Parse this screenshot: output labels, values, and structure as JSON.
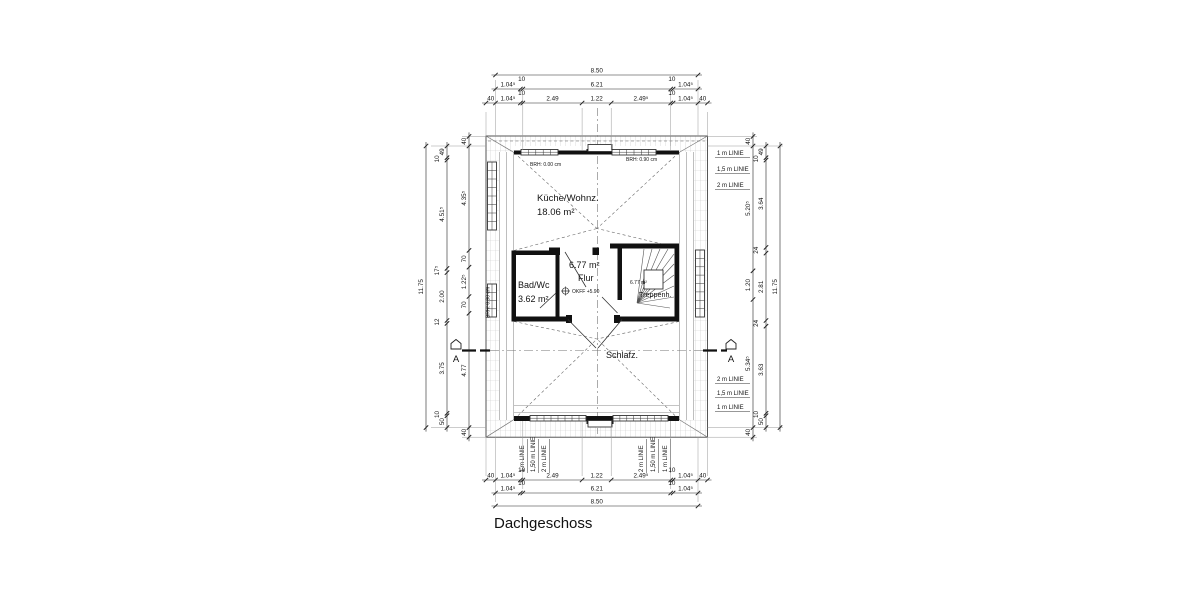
{
  "title": "Dachgeschoss",
  "rooms": {
    "kueche": {
      "name": "Küche/Wohnz.",
      "area": "18.06 m²"
    },
    "flur": {
      "name": "Flur",
      "area": "6.77 m²"
    },
    "bad": {
      "name": "Bad/Wc",
      "area": "3.62 m²"
    },
    "treppenhaus": {
      "name": "Treppenh.",
      "area": "6.77 m²"
    },
    "schlafzimmer": {
      "name": "Schlafz."
    }
  },
  "annotations": {
    "brh_left_window": "BRH: 0.00 cm",
    "brh_right_window": "BRH: 0.90 cm",
    "brh_side_window": "BRH: 0.90 cm",
    "okff": "OKFF +5.90",
    "section_label": "A"
  },
  "dims": {
    "top": {
      "overall": "8.50",
      "row2": [
        "1.04⁵",
        "10",
        "6.21",
        "10",
        "1.04⁵"
      ],
      "row3": [
        "40",
        "1.04⁵",
        "10",
        "2.49",
        "1.22",
        "2.49⁵",
        "10",
        "1.04⁵",
        "40"
      ]
    },
    "bottom": {
      "overall": "8.50",
      "row1": [
        "40",
        "1.04⁵",
        "10",
        "2.49",
        "1.22",
        "2.49⁵",
        "10",
        "1.04⁵",
        "40"
      ],
      "row2": [
        "1.04⁵",
        "10",
        "6.21",
        "10",
        "1.04⁵"
      ]
    },
    "left": {
      "overall": "11.75",
      "middle": [
        "49",
        "10",
        "4.51⁵",
        "17⁵",
        "2.00",
        "12",
        "3.75",
        "10",
        "50"
      ],
      "inner": [
        "40",
        "4.35⁵",
        "70",
        "1.22⁵",
        "70",
        "4.77",
        "40"
      ]
    },
    "right": {
      "overall": "11.75",
      "middle": [
        "49",
        "10",
        "3.64",
        "24",
        "2.81",
        "24",
        "3.63",
        "10",
        "50"
      ],
      "inner": [
        "40",
        "5.20⁵",
        "1.20",
        "5.34⁵",
        "40"
      ]
    }
  },
  "linie_labels": {
    "right_top": [
      "1 m LINIE",
      "1,5 m LINIE",
      "2 m LINIE"
    ],
    "right_bottom": [
      "2 m LINIE",
      "1,5 m LINIE",
      "1 m LINIE"
    ],
    "bottom_left": [
      "1 m LINIE",
      "1,50 m LINIE",
      "2 m LINIE"
    ],
    "bottom_right": [
      "2 m LINIE",
      "1,50 m LINIE",
      "1 m LINIE"
    ]
  }
}
